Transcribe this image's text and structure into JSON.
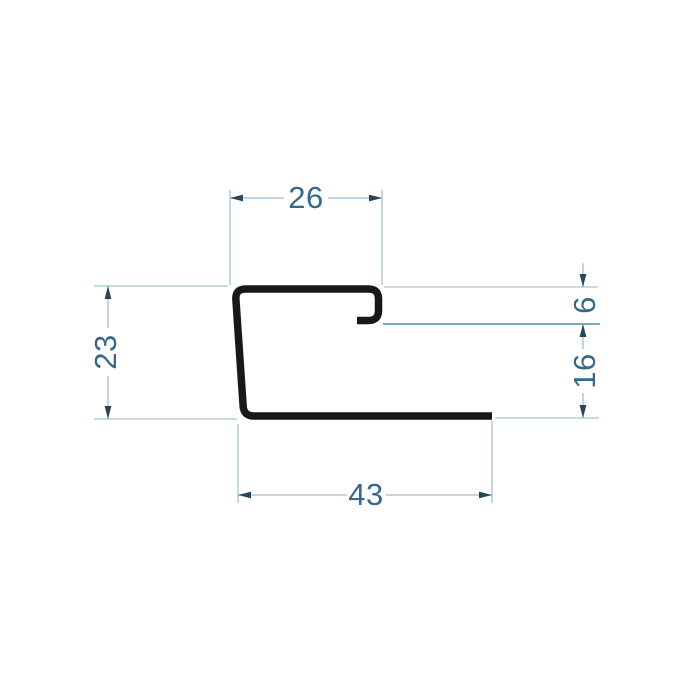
{
  "drawing": {
    "title": "profile-cross-section-technical-drawing",
    "shape": "J-shaped metal trim profile with top return hook",
    "units_shown": false,
    "dimensions": {
      "top_width": "26",
      "left_height": "23",
      "hook_depth": "6",
      "right_lower_height": "16",
      "bottom_width": "43"
    },
    "colors": {
      "background": "#ffffff",
      "profile_stroke": "#181818",
      "extension_line": "#a6c3d2",
      "extension_line_dark": "#6f9cb0",
      "dimension_line": "#9dbed0",
      "arrowhead": "#26475a",
      "dimension_text": "#35688a"
    }
  }
}
